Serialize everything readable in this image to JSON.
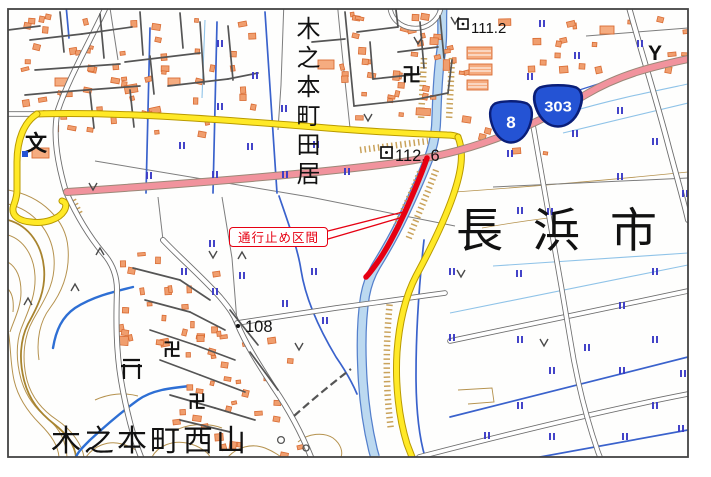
{
  "map": {
    "region_labels": {
      "kinomoto_tai": "木之本町田居",
      "nagahama_city": "長浜市",
      "kinomoto_nishiyama": "木之本町西山"
    },
    "closure_label": "通行止め区間",
    "elevations": [
      {
        "value": "111.2"
      },
      {
        "value": "112. 6"
      },
      {
        "value": "108"
      }
    ],
    "routes": [
      {
        "number": "8"
      },
      {
        "number": "303"
      }
    ],
    "symbols": {
      "school": "文",
      "temple": "卍",
      "mulberry_field": "Y"
    },
    "colors": {
      "closure_red": "#e60012",
      "route_shield_blue": "#2453d4",
      "national_road_pink": "#f1939d",
      "prefectural_road_yellow": "#ffe927",
      "water_blue": "#3a62cc",
      "paddy_mark_blue": "#3a3ac6",
      "contour_tan": "#b5924e"
    }
  }
}
